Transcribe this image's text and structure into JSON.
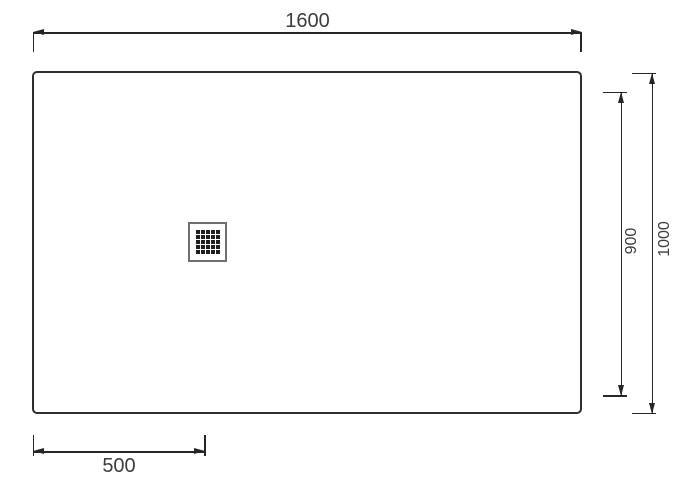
{
  "drawing": {
    "dimensions": {
      "width_label": "1600",
      "overall_height_label": "1000",
      "inner_height_label": "900",
      "drain_offset_label": "500"
    },
    "drain_grate": {
      "rows": 5,
      "cols": 5
    },
    "colors": {
      "line": "#262626",
      "text": "#3d3d3d",
      "tray_border": "#2e2e2e",
      "grate_border": "#6f6f6f",
      "grate_dot": "#1f1f1f",
      "background": "#ffffff"
    }
  }
}
